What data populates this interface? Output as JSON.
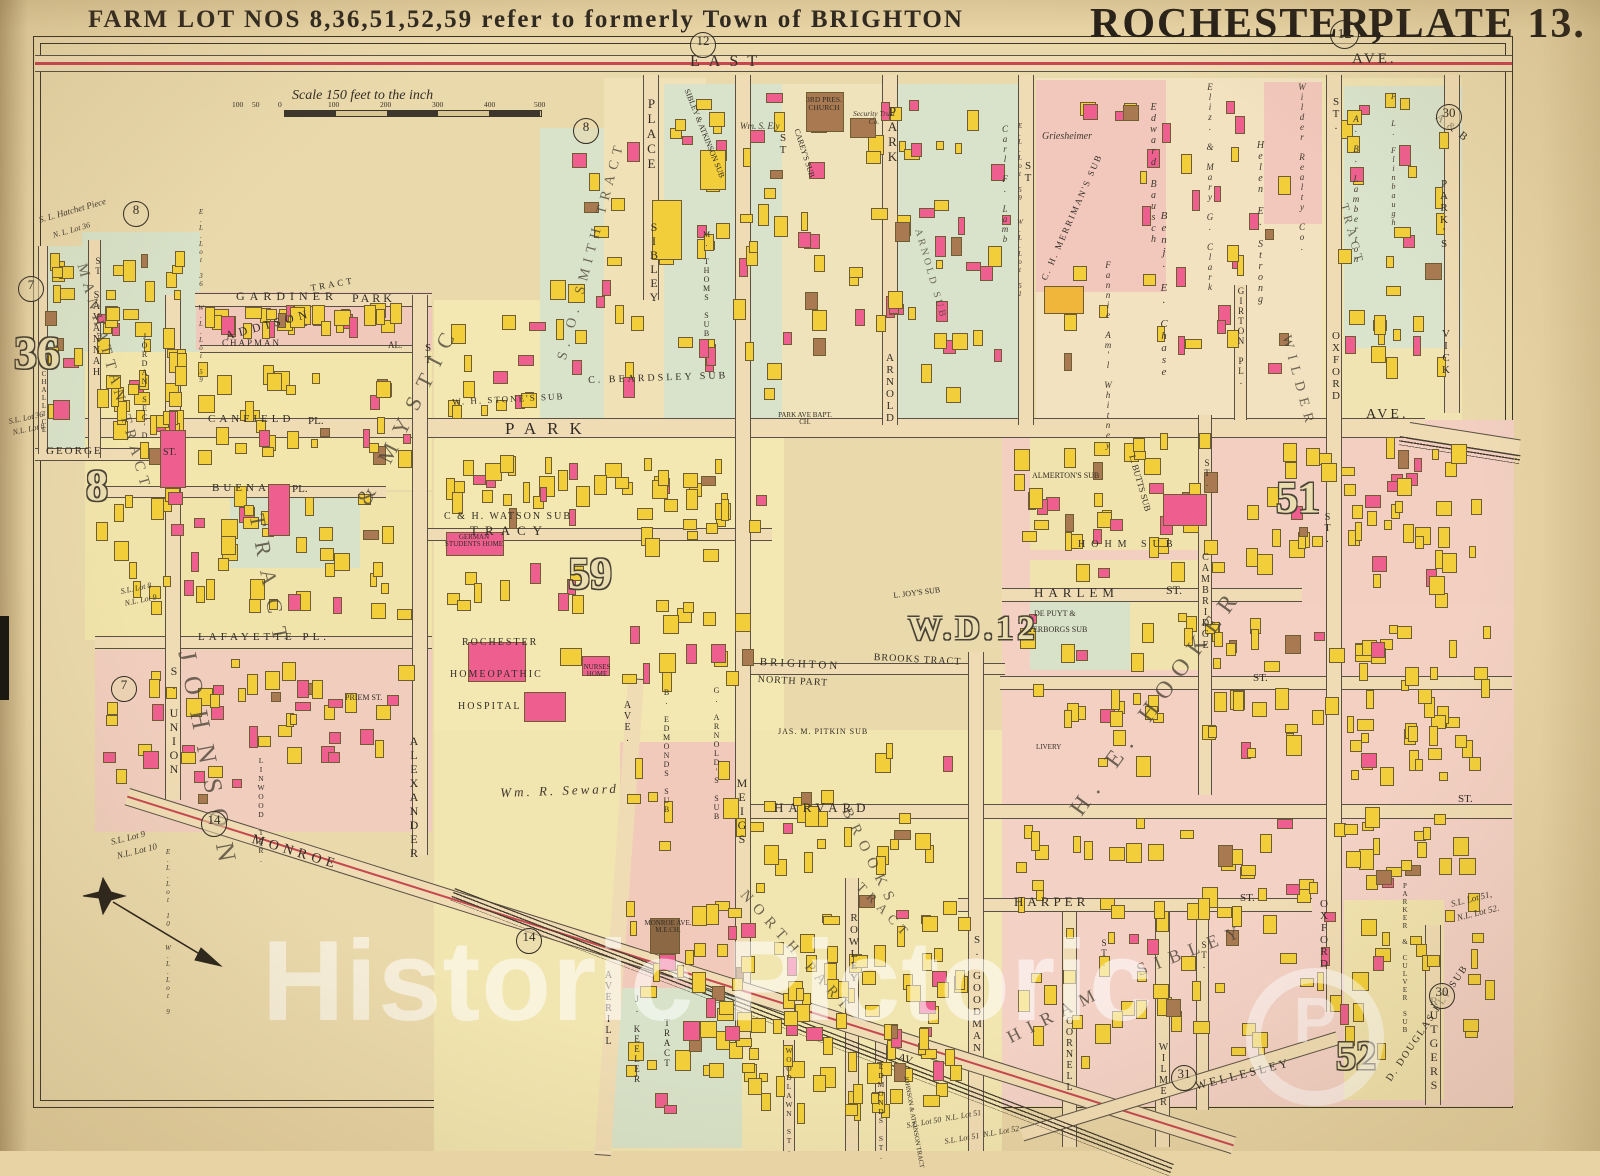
{
  "plate": {
    "note": "FARM LOT NOS 8,36,51,52,59 refer to formerly Town of BRIGHTON",
    "title_city": "ROCHESTER,",
    "title_plate": "PLATE 13.",
    "badge": "12"
  },
  "scale": {
    "caption": "Scale 150 feet to the inch",
    "ticks": [
      "100",
      "50",
      "0",
      "100",
      "200",
      "300",
      "400",
      "500"
    ]
  },
  "watermark": {
    "text": "Historic Pictoric",
    "logo": "P"
  },
  "badges": {
    "n12": "12",
    "n8": "8",
    "n7": "7",
    "n14": "14",
    "n30": "30",
    "n31": "31"
  },
  "farmlots": {
    "n36": "36",
    "n8": "8",
    "n59": "59",
    "n51": "51",
    "n52": "52",
    "ward": "W.D.12"
  },
  "streets": {
    "east": "EAST",
    "ave_top": "AVE.",
    "park": "PARK",
    "ave_mid": "AVE.",
    "gardiner": "GARDINER",
    "gardiner_park": "PARK",
    "chapman": "CHAPMAN",
    "chapman_al": "AL.",
    "canfield": "CANFIELD",
    "canfield_pl": "PL.",
    "buena": "BUENA",
    "buena_pl": "PL.",
    "lafayette": "LAFAYETTE PL.",
    "george": "GEORGE",
    "george_st": "ST.",
    "tracy": "TRACY",
    "savannah": "SAVANNAH",
    "savannah_st": "ST",
    "challice": "CHALLICE",
    "s_union": "S. UNION",
    "alexander": "ALEXANDER",
    "alexander_st": "ST",
    "sibley": "SIBLEY",
    "sibley_place": "PLACE",
    "meigs": "MEIGS",
    "meigs_st": "ST",
    "arnold": "ARNOLD",
    "arnold_park": "PARK",
    "st_plain": "ST",
    "girton": "GIRTON PL.",
    "cambridge": "CAMBRIDGE",
    "cambridge_st": "ST.",
    "oxford": "OXFORD",
    "oxford_st": "ST.",
    "vick": "VICK",
    "vick_parks": "PARK'S",
    "vick_ab": "A & B",
    "harlem": "HARLEM",
    "harlem_st": "ST.",
    "st_dot": "ST.",
    "harvard": "HARVARD",
    "harper": "HARPER",
    "monroe": "MONROE",
    "monroe_av": "AV.",
    "averill_ave": "AVE.",
    "averill": "AVERILL",
    "goodman": "S. GOODMAN",
    "rowley": "ROWLEY",
    "edmonds": "EDMONDS ST.",
    "woodlawn": "WOODLAWN ST.",
    "cornell": "CORNELL",
    "wilmer": "WILMER",
    "wellesley": "WELLESLEY",
    "rutgers": "RUTGERS",
    "priem": "PRIEM ST.",
    "linwood": "LINWOOD TER."
  },
  "tracts": {
    "manhattan": "MANHATTAN TRACT",
    "smith": "S. O. SMITH TRACT",
    "johnson": "JOHNSON",
    "amp_mystic": "& MYSTIC",
    "tract": "TRACT",
    "addison": "ADDISON",
    "brighton": "BRIGHTON",
    "north_part_line": "NORTH PART",
    "brooks_line": "BROOKS TRACT",
    "north_part": "NORTH PART",
    "brooks": "BROOKS",
    "hooker": "H. E. HOOKER",
    "hiram": "HIRAM",
    "sibley_big": "SIBLEY",
    "wilder": "WILDER",
    "keeler": "J. KEELER",
    "keeler_tract": "TRACT",
    "johnson_atkinson": "JOHNSON & ATKINSON TRACT"
  },
  "subs": {
    "jordan": "JORDAN SEC'D",
    "beardsley": "C. BEARDSLEY SUB",
    "stones": "W. H. STONE'S SUB",
    "watson": "C & H. WATSON SUB",
    "sibley_atkinson": "SIBLEY & ATKINSON SUB",
    "thoms": "M. THOMS SUB",
    "careys": "CAREY'S SUB",
    "arnold_sub": "ARNOLD SUB",
    "arnolds": "G. ARNOLD'S SUB",
    "edmonds_sub": "B. EDMONDS SUB",
    "joys": "L. JOY'S SUB",
    "pitkin": "JAS. M. PITKIN SUB",
    "depuyt1": "DE PUYT &",
    "depuyt2": "TERBORGS SUB",
    "hohm": "HOHM SUB",
    "almerton": "ALMERTON'S SUB",
    "butts": "L. BUTTS SUB",
    "merriman": "C. H. MERRIMAN'S SUB",
    "parker_culver": "PARKER & CULVER SUB",
    "douglas_ely": "D. DOUGLAS ELY SUB"
  },
  "owners": {
    "griesheimer": "Griesheimer",
    "bausch": "Edward Bausch",
    "chase": "Benj. E. Chase",
    "clark": "Eliz. & Mary G. Clark",
    "strong": "Helen E. Strong",
    "wilder_realty": "Wilder Realty Co.",
    "whitney": "Fannie Am'l Whitney",
    "lamberton": "A. B. Lamberton",
    "lamb": "Carl F. Lamb",
    "flinbaugh": "F. L. Flinbaugh",
    "seward": "Wm. R. Seward",
    "ely": "Wm. S. Ely"
  },
  "places": {
    "pres_church": "3RD PRES. CHURCH",
    "security": "Security Trust Co.",
    "bapt": "PARK AVE BAPT. CH.",
    "german": "GERMAN STUDENTS HOME",
    "hosp1": "ROCHESTER",
    "hosp2": "HOMEOPATHIC",
    "hosp3": "HOSPITAL",
    "nurses": "NURSES HOME",
    "monroe_me": "MONROE AVE. M.E.CH.",
    "livery": "LIVERY"
  },
  "lots": {
    "hatchet1": "S. L. Hatchet Piece",
    "hatchet2": "N. L. Lot 36",
    "el36": "E.L.Lot 36  W.L.Lot 59",
    "sl36": "S.L. Lot 36",
    "nl8": "N.L. Lot 8",
    "sl8": "S.L. Lot 8",
    "nl9": "N.L. Lot 9",
    "sl9": "S.L. Lot 9",
    "nl10": "N.L. Lot 10",
    "el10": "E.L.Lot 10  W.L.Lot 9",
    "el59": "E.L.Lot 59  W.L.Lot 51",
    "sl51": "S.L. Lot 51,",
    "nl52": "N.L. Lot 52.",
    "sl50": "S.L. Lot 50  N.L. Lot 51",
    "sl51b": "S.L. Lot 51  N.L. Lot 52"
  },
  "colors": {
    "parchment": "#e7d3a4",
    "block_yellow": "#f3e7b0",
    "block_pink": "#f2cbbd",
    "block_green": "#d9e3c9",
    "building_yellow": "#f2cf3a",
    "building_pink": "#ee5f8f",
    "building_brown": "#a97a52",
    "trolley_red": "#c64750",
    "ink": "#332d26"
  }
}
